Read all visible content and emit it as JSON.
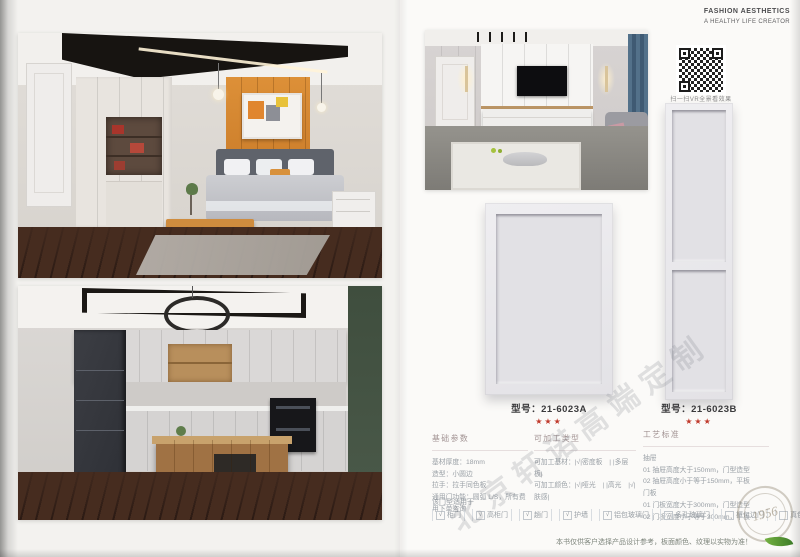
{
  "brand": {
    "line1": "FASHION AESTHETICS",
    "line2": "A HEALTHY LIFE CREATOR"
  },
  "qr": {
    "caption": "扫一扫VR全景看效果",
    "icon": "qr-code-icon"
  },
  "products": [
    {
      "model": "型号：21-6023A",
      "stars": "★★★"
    },
    {
      "model": "型号：21-6023B",
      "stars": "★★★"
    }
  ],
  "specs": {
    "basic": {
      "title": "基础参数",
      "lines": [
        "基材厚度：18mm",
        "造型：小圆边",
        "拉手：拉手同色板",
        "通用门功能：圆弧 L/S，所有费用下单咨询"
      ]
    },
    "process": {
      "title": "可加工类型",
      "lines": [
        "可加工基材：|√|密度板　| |多层板|",
        "可加工颜色：|√|哑光　| |高光　|√|肤感|"
      ]
    },
    "standard": {
      "title": "工艺标准",
      "lines": [
        "抽屉",
        "01 抽屉高度大于150mm，门型造型",
        "02 抽屉高度小于等于150mm，平板",
        "门板",
        "01 门板宽度大于300mm，门型造型",
        "02 门板宽度小于等于300mm，平板"
      ]
    }
  },
  "applicable": {
    "label": "该门型适用于",
    "items": [
      {
        "mark": "√",
        "label": "柜门"
      },
      {
        "mark": "√",
        "label": "高柜门"
      },
      {
        "mark": "√",
        "label": "趟门"
      },
      {
        "mark": "√",
        "label": "护墙"
      },
      {
        "mark": "√",
        "label": "铝包玻璃门"
      },
      {
        "mark": "",
        "label": "多孔玻璃门"
      },
      {
        "mark": "",
        "label": "框包边门"
      },
      {
        "mark": "",
        "label": "真包边门"
      },
      {
        "mark": "",
        "label": "网格门"
      },
      {
        "mark": "",
        "label": "嵌条玻璃门"
      }
    ]
  },
  "watermark": "北京轩诺高端定制",
  "stamp": "1956",
  "footer": {
    "note": "本书仅供客户选择产品设计参考，板面颜色、纹理以实物为准！",
    "icon": "leaf-icon"
  },
  "colors": {
    "star_red": "#c0392b",
    "leaf_green": "#4e9c3a",
    "accent_orange": "#d98a33",
    "watermark_gray": "#82848a"
  }
}
